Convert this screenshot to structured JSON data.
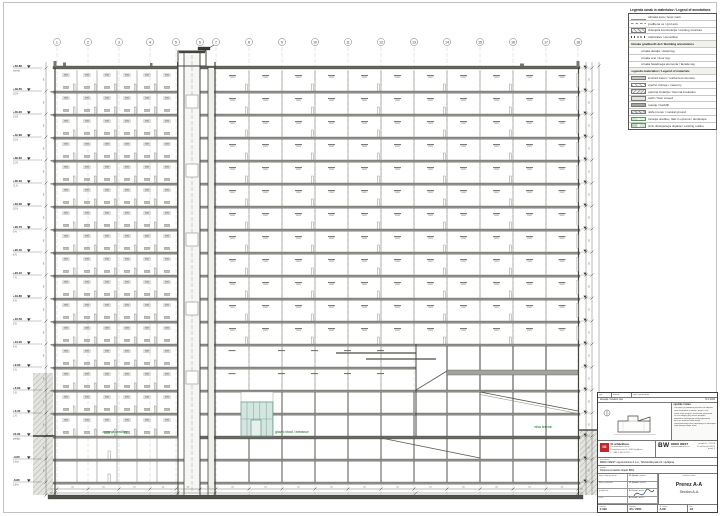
{
  "legend": {
    "title": "Legenda oznak in materialov / Legend of annotations",
    "rows": [
      {
        "type": "sym-level",
        "text": "višinska kota / level mark"
      },
      {
        "type": "sym-axis",
        "text": "gradbena os / grid axis"
      },
      {
        "type": "sym-exist",
        "text": "obstoječa konstrukcija / existing structure"
      },
      {
        "type": "sym-demo",
        "text": "odstranitev / demolition"
      },
      {
        "type": "header",
        "text": "Oznake gradbenih del / Building annotations"
      },
      {
        "type": "text",
        "text": "oznaka detajla / detail tag"
      },
      {
        "type": "text",
        "text": "oznaka vrat / door tag"
      },
      {
        "type": "text",
        "text": "oznaka fasadnega elementa / facade tag"
      },
      {
        "type": "header",
        "text": "Legenda materialov / Legend of materials"
      },
      {
        "type": "fill-conc",
        "text": "armirani beton / reinforced concrete"
      },
      {
        "type": "fill-brick",
        "text": "opečno zidovje / masonry"
      },
      {
        "type": "fill-ins",
        "text": "toplotna izolacija / thermal insulation"
      },
      {
        "type": "fill-screed",
        "text": "estrih / floor screed"
      },
      {
        "type": "fill-fill",
        "text": "nasutje / backfill"
      },
      {
        "type": "fill-soil",
        "text": "raščen teren / natural ground"
      },
      {
        "type": "green-a",
        "text": "zunanja ureditev, tlaki in oprema / landscape"
      },
      {
        "type": "green-b",
        "text": "obris obstoječega objekta / existing outline"
      }
    ]
  },
  "grid": {
    "bubbles": [
      "1",
      "2",
      "3",
      "4",
      "5",
      "6",
      "7",
      "8",
      "9",
      "10",
      "11",
      "12",
      "13",
      "14",
      "15",
      "16",
      "17",
      "18"
    ]
  },
  "levels": [
    {
      "elev": "+52.80",
      "name": "streha"
    },
    {
      "elev": "+49.50",
      "name": "15.N"
    },
    {
      "elev": "+46.20",
      "name": "14.N"
    },
    {
      "elev": "+42.90",
      "name": "13.N"
    },
    {
      "elev": "+39.60",
      "name": "12.N"
    },
    {
      "elev": "+36.30",
      "name": "11.N"
    },
    {
      "elev": "+33.00",
      "name": "10.N"
    },
    {
      "elev": "+29.70",
      "name": "9.N"
    },
    {
      "elev": "+26.40",
      "name": "8.N"
    },
    {
      "elev": "+23.10",
      "name": "7.N"
    },
    {
      "elev": "+19.80",
      "name": "6.N"
    },
    {
      "elev": "+16.50",
      "name": "5.N"
    },
    {
      "elev": "+13.20",
      "name": "4.N"
    },
    {
      "elev": "+9.90",
      "name": "3.N"
    },
    {
      "elev": "+6.60",
      "name": "2.N"
    },
    {
      "elev": "+3.30",
      "name": "1.N"
    },
    {
      "elev": "±0.00",
      "name": "pritličje"
    },
    {
      "elev": "-3.60",
      "name": "1.klet"
    },
    {
      "elev": "-6.80",
      "name": "2.klet"
    }
  ],
  "green_labels": [
    "zunanja ureditev",
    "glavni vhod / entrance",
    "nivo terena"
  ],
  "titleblock": {
    "rev_cells": [
      "spr.",
      "datum",
      "opis spremembe"
    ],
    "site_left": "situacija / location plan",
    "site_right": "M 1:2000",
    "notes_title": "opombe / notes:",
    "notes": [
      "Vse mere je potrebno preveriti na objektu.",
      "Kote so podane v metrih, mere v cm.",
      "Risba velja skupaj s tehničnim poročilom.",
      "Za vse detajle glej načrte detajlov.",
      "Morebitna odstopanja javiti projektantu.",
      "Načrt je avtorsko delo biroja.",
      "Razmnoževanje brez dovoljenja ni dovoljeno.",
      "Velja zadnja izdaja risbe."
    ],
    "arch_logo": "IG",
    "arch_name": "IG arhitektura",
    "arch_l1": "IG arhitektura d.o.o.",
    "arch_l2": "Dunajska cesta 5, 1000 Ljubljana",
    "arch_l3": "t: +386 1 300 10 10",
    "bw_logo": "BW",
    "bw_name": "BRDO WEST",
    "bw_sub": "nepremičnine d.o.o.",
    "bw_r1": "projekt št.: 21-014",
    "bw_r2": "št. načrta: A-214/21",
    "bw_r3": "izvod: 1",
    "inv_label": "investitor:",
    "inv_value": "BRDO WEST nepremičnine d.o.o., Tehnološki park 21, Ljubljana",
    "obj_label": "objekt:",
    "obj_value": "Poslovno-hotelski objekt BW1",
    "sig_rows": [
      {
        "k": "odg. vodja projekta:",
        "v": "M. Novak, u.d.i.a."
      },
      {
        "k": "odg. projektant:",
        "v": "M. Novak, u.d.i.a."
      },
      {
        "k": "projektant:",
        "v": "A. Kovač, m.i.a."
      },
      {
        "k": "risal:",
        "v": "A. Kovač, m.i.a."
      }
    ],
    "title_label": "vsebina risbe:",
    "drawing_title": "Prerez A-A",
    "drawing_subtitle": "Section A-A",
    "scale_label": "merilo:",
    "scale": "1:100",
    "date_label": "datum:",
    "date": "05 / 2021",
    "sheet_label": "št. risbe:",
    "sheet_no": "A.08",
    "list_label": "list:",
    "list_no": "1/1"
  }
}
